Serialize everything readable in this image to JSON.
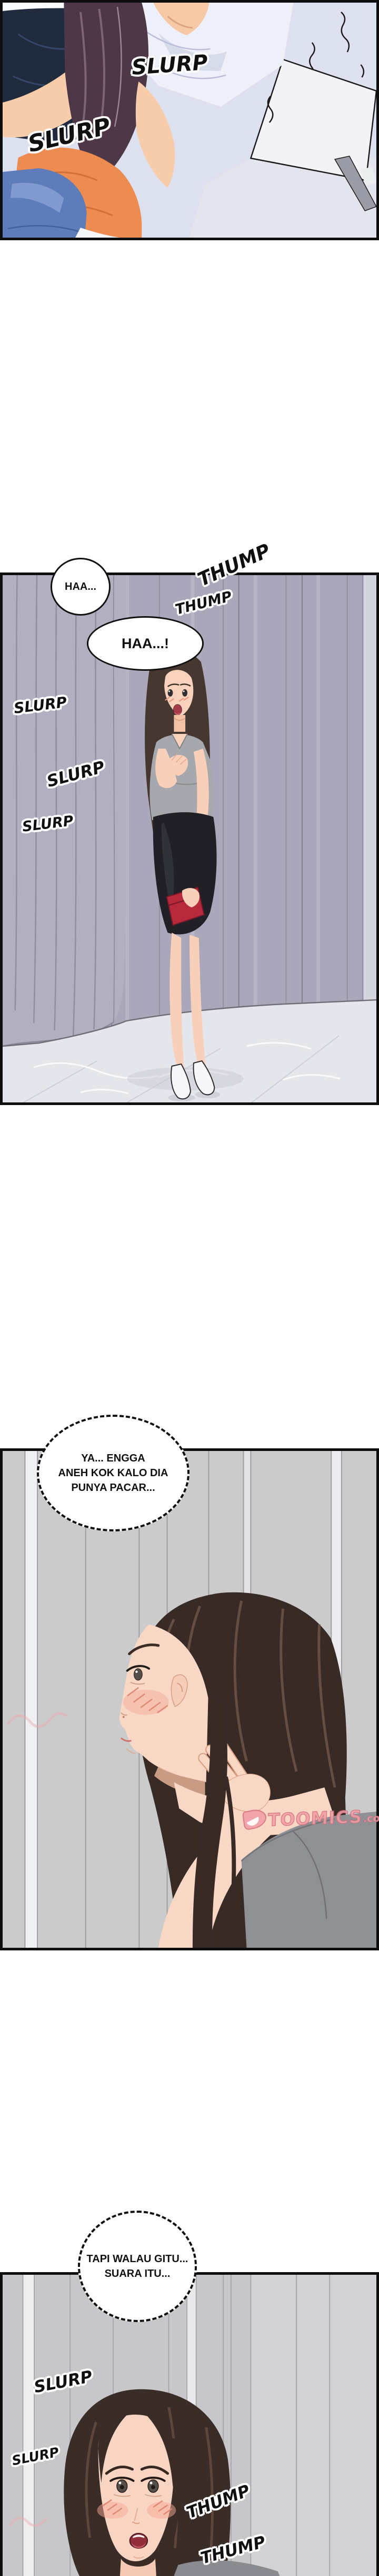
{
  "page": {
    "kind": "webtoon-comic-page",
    "background": "#ffffff",
    "panel_count": 4
  },
  "colors": {
    "panel_border": "#0e0e0e",
    "sfx_fill": "#101010",
    "sfx_outline": "#ffffff",
    "bubble_border": "#101010",
    "bubble_fill": "#ffffff",
    "watermark_pink": "#f09da6",
    "watermark_outline": "#d4707c",
    "p1_bedding": "#dde1ef",
    "p1_navy": "#202b3e",
    "p1_hair": "#4e3847",
    "p1_shirt_orange": "#ec8c51",
    "p1_jeans": "#5e7cba",
    "p2_wall": "#a9a7b9",
    "p2_floor": "#e5e6eb",
    "p2_skirt": "#202026",
    "p2_clutch": "#b8293c",
    "p3_wall": "#cbcbcb",
    "p3_tee": "#8f9094",
    "p3_hair": "#382b26",
    "p4_wall": "#c7c7c9",
    "p4_hair": "#3a2c27",
    "p4_mouth": "#922f3a"
  },
  "panel1": {
    "description": "close-up of woman in orange top leaning over person in white shirt",
    "sfx": [
      {
        "text": "SLURP"
      },
      {
        "text": "SLURP"
      }
    ]
  },
  "panel2": {
    "description": "woman standing in hallway with red clutch",
    "bubbles": [
      {
        "text": "HAA..."
      },
      {
        "text": "HAA...!"
      }
    ],
    "sfx": [
      {
        "text": "THUMP"
      },
      {
        "text": "THUMP"
      },
      {
        "text": "SLURP"
      },
      {
        "text": "SLURP"
      },
      {
        "text": "SLURP"
      }
    ]
  },
  "panel3": {
    "description": "profile close-up of blushing woman, hand at chin",
    "thought": {
      "lines": [
        "YA... ENGGA",
        "ANEH KOK KALO DIA",
        "PUNYA PACAR..."
      ]
    },
    "watermark": {
      "brand": "TOOMICS",
      "tld": ".com"
    }
  },
  "panel4": {
    "description": "worried blushing woman facing forward",
    "thought": {
      "lines": [
        "TAPI WALAU GITU...",
        "SUARA ITU..."
      ]
    },
    "sfx": [
      {
        "text": "SLURP"
      },
      {
        "text": "SLURP"
      },
      {
        "text": "THUMP"
      },
      {
        "text": "THUMP"
      }
    ]
  }
}
